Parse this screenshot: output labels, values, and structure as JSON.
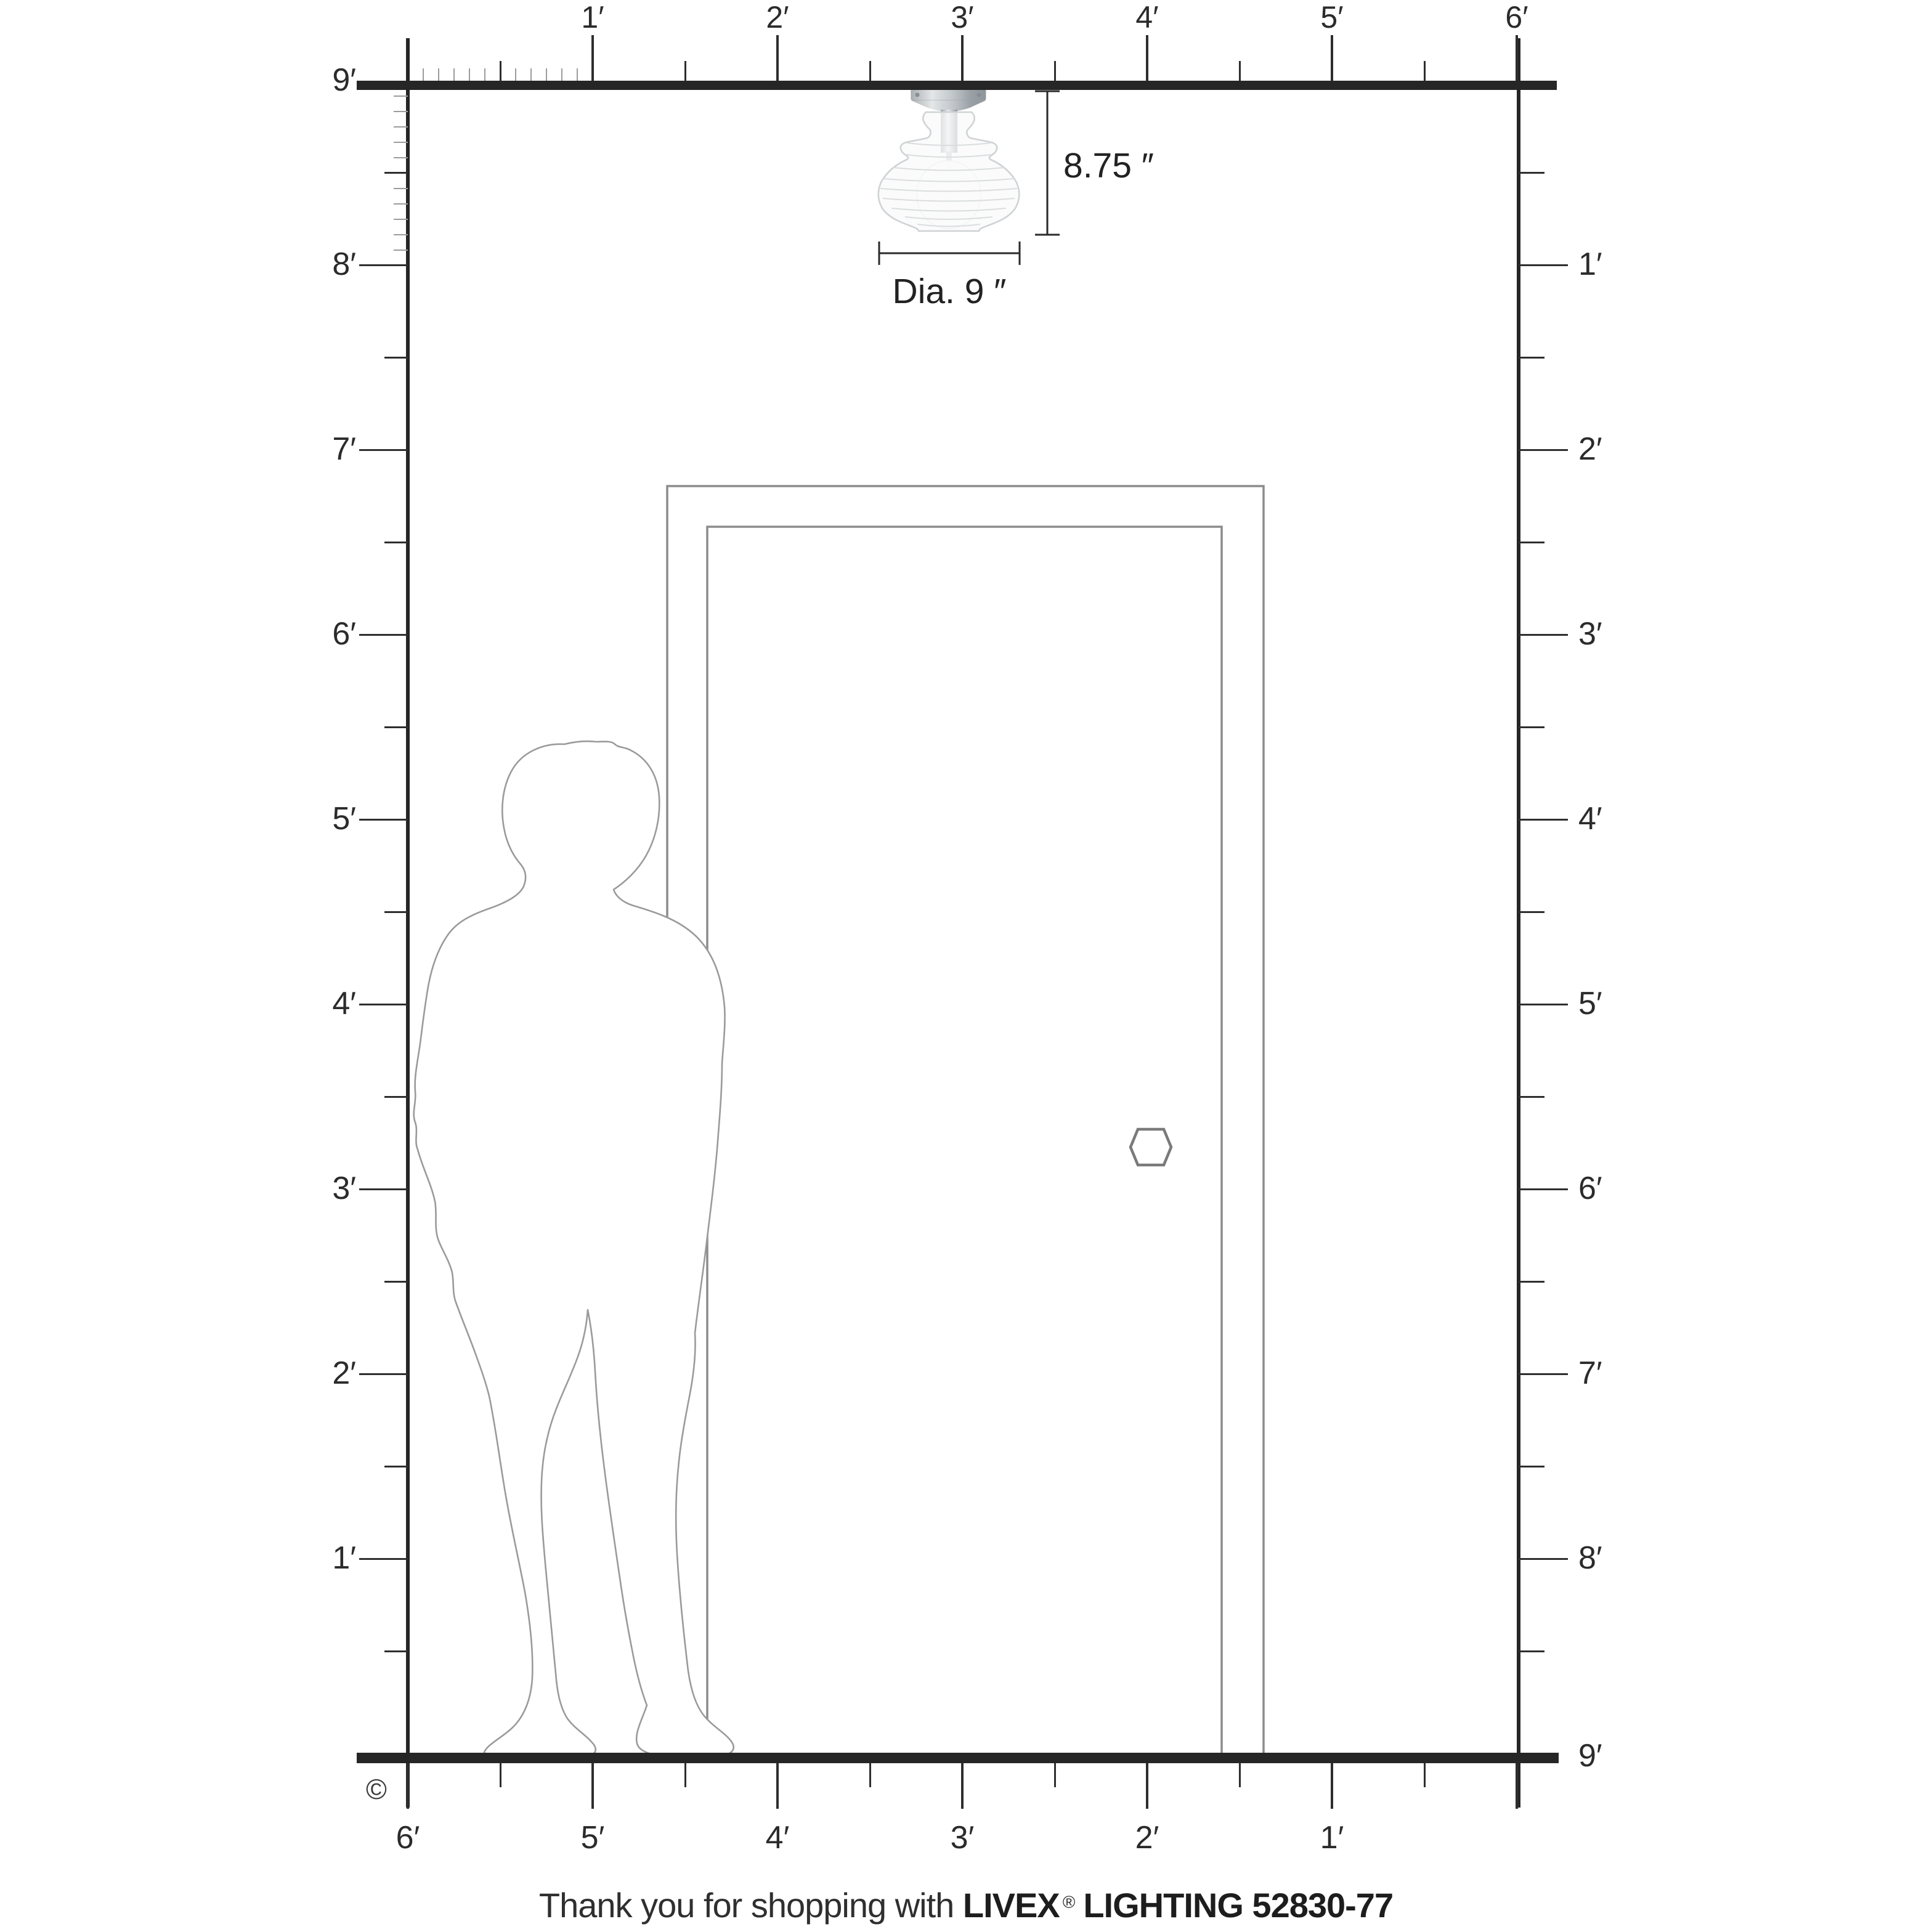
{
  "rulers": {
    "top": {
      "labels": [
        "1′",
        "2′",
        "3′",
        "4′",
        "5′",
        "6′"
      ]
    },
    "left": {
      "labels": [
        "9′",
        "8′",
        "7′",
        "6′",
        "5′",
        "4′",
        "3′",
        "2′",
        "1′"
      ]
    },
    "right": {
      "labels": [
        "1′",
        "2′",
        "3′",
        "4′",
        "5′",
        "6′",
        "7′",
        "8′",
        "9′"
      ]
    },
    "bottom": {
      "labels": [
        "6′",
        "5′",
        "4′",
        "3′",
        "2′",
        "1′"
      ]
    }
  },
  "fixture": {
    "height_label": "8.75 ″",
    "diameter_label": "Dia. 9 ″"
  },
  "footer": {
    "message": "Thank you for shopping with",
    "brand": "LIVEX",
    "registered": "®",
    "product": "LIGHTING 52830-77",
    "copyright": "©"
  },
  "colors": {
    "bar": "#262626",
    "tick_major": "#2e2e2e",
    "tick_minor": "#9b9b9b",
    "text": "#2b2b2b",
    "door_outline": "#8c8c8c",
    "person_outline": "#9a9a9a",
    "metal": "#b7bcc0",
    "glass_line": "#cfd3d5"
  }
}
